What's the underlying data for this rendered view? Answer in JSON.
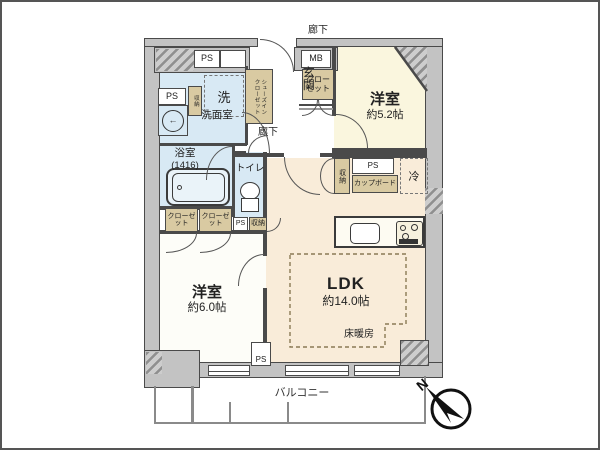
{
  "plan": {
    "rooms": {
      "bedroom1": {
        "name": "洋室",
        "size": "約5.2帖"
      },
      "bedroom2": {
        "name": "洋室",
        "size": "約6.0帖"
      },
      "ldk": {
        "name": "LDK",
        "size": "約14.0帖"
      },
      "entrance": {
        "name": "玄関"
      },
      "washroom": {
        "name": "洗面室"
      },
      "bathroom": {
        "name": "浴室",
        "size": "(1416)"
      },
      "toilet": {
        "name": "トイレ"
      },
      "hallway": {
        "name": "廊下"
      },
      "outer_corridor": {
        "name": "廊下"
      },
      "balcony": {
        "name": "バルコニー"
      }
    },
    "features": {
      "floor_heating": "床暖房",
      "washer": "洗",
      "fridge": "冷",
      "cupboard": "カップボード",
      "storage": "収納",
      "closet": "クローゼット",
      "shoes_closet_l1": "シューズイン",
      "shoes_closet_l2": "クローゼット",
      "ps": "PS",
      "mb": "MB",
      "north": "N"
    },
    "colors": {
      "wall_dark": "#4a4a4a",
      "wall_gray": "#c3c3c3",
      "wet_fill": "#d8e9f4",
      "closet_fill": "#d9caa2",
      "bedroom1_fill": "#faf6de",
      "bedroom2_fill": "#fdfdf8",
      "ldk_fill": "#f9ecd9",
      "balcony_line": "#8a8a8a"
    }
  }
}
